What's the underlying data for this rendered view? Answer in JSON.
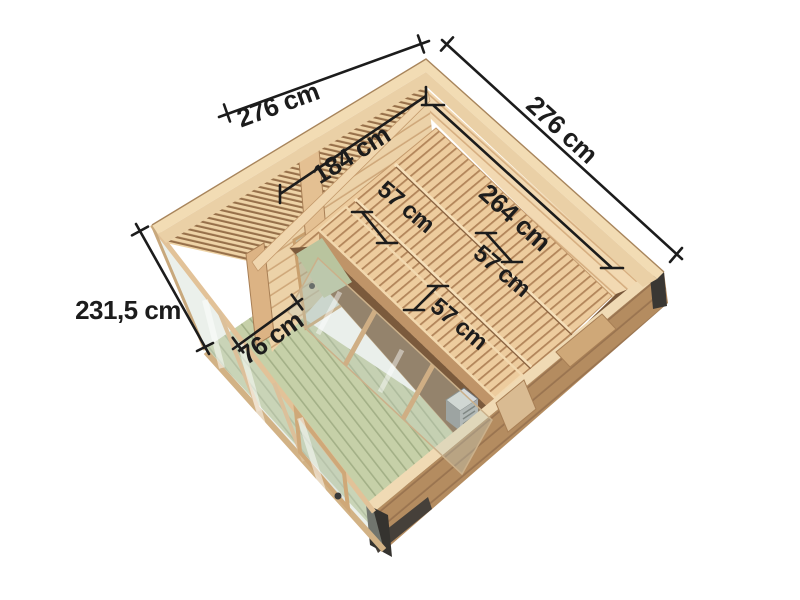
{
  "dimension_labels": {
    "outer_left": "276 cm",
    "outer_right": "276 cm",
    "interior_width": "184 cm",
    "interior_depth": "264 cm",
    "bench_depth_upper": "57 cm",
    "bench_depth_middle": "57 cm",
    "bench_depth_lower": "57 cm",
    "anteroom_width": "76 cm",
    "wall_height": "231,5 cm"
  },
  "colors": {
    "background": "#ffffff",
    "dimension_ink": "#1c1c1c",
    "wood_light": "#f2dcb4",
    "wood_top": "#ead0a6",
    "wood_plank_inner": "#ecd2a8",
    "wood_exterior": "#b48c60",
    "wood_shadow": "#77573a",
    "bench_wood": "#edcc9e",
    "deck_green": "#c6d0a8",
    "glass_tint": "#ccd8cc",
    "post_dark": "#35332f"
  }
}
